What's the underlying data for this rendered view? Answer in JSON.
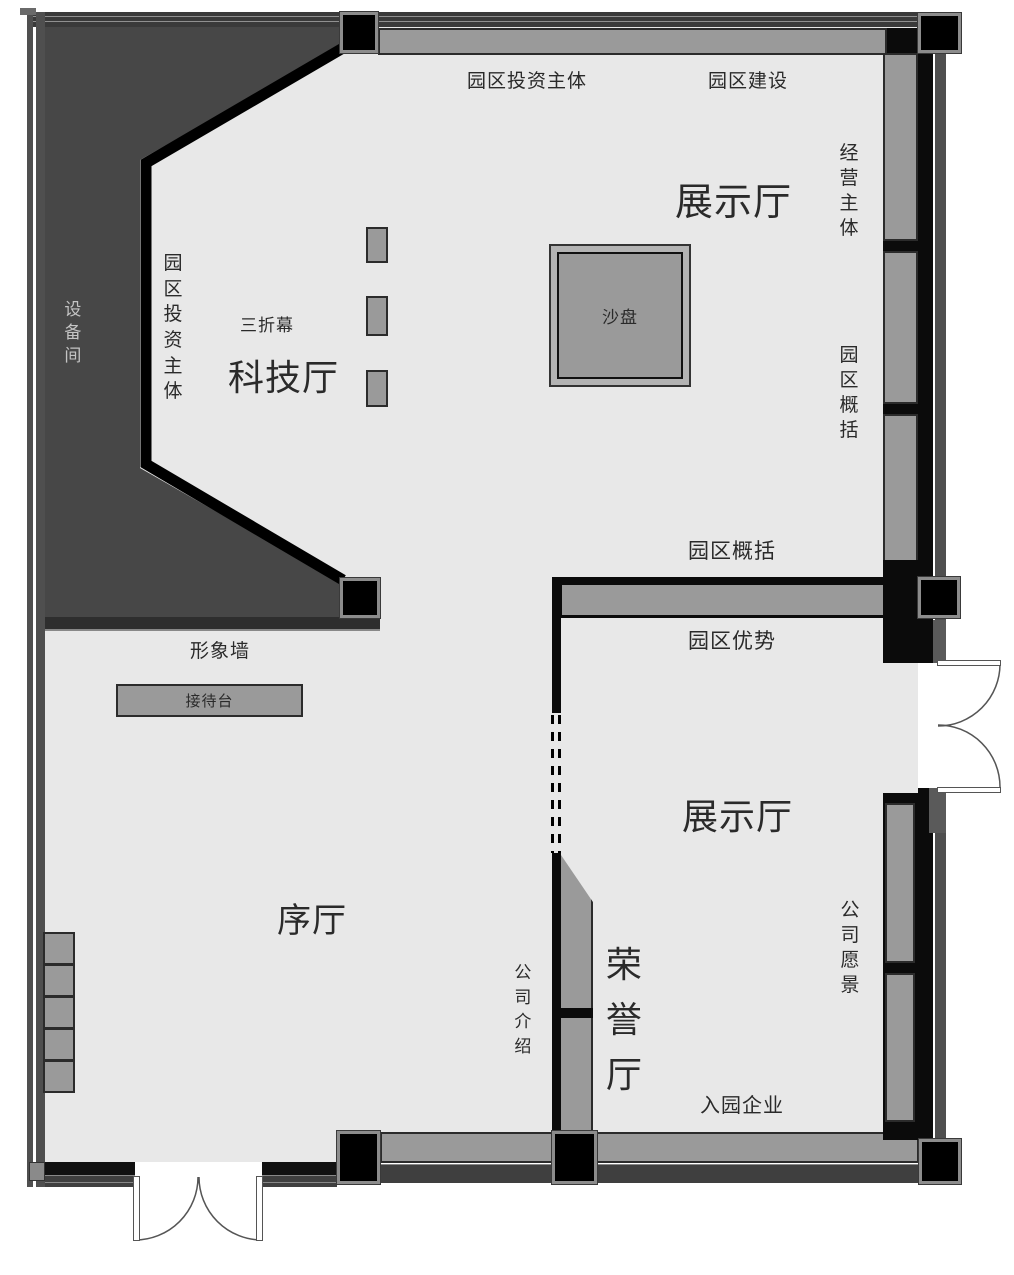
{
  "title": "exhibition-hall-floor-plan",
  "labels": {
    "park_investor_top": "园区投资主体",
    "park_construction": "园区建设",
    "exhibition_hall_upper": "展示厅",
    "operating_entity": "经营主体",
    "equipment_room": "设备间",
    "park_investor_left": "园区投资主体",
    "triple_screen": "三折幕",
    "tech_hall": "科技厅",
    "sand_table": "沙盘",
    "park_overview_right": "园区概括",
    "park_overview_mid": "园区概括",
    "park_advantage": "园区优势",
    "image_wall": "形象墙",
    "reception_desk": "接待台",
    "foyer": "序厅",
    "exhibition_hall_lower": "展示厅",
    "company_vision": "公司愿景",
    "company_intro": "公司介绍",
    "honor_hall": "荣誉厅",
    "enterprises_in_park": "入园企业"
  },
  "colors": {
    "floor": "#e8e8e8",
    "equipment_room_fill": "#474747",
    "wall_black": "#0b0b0b",
    "display_panel_gray": "#9a9a9a",
    "outer_trim_gray": "#4f4f4f",
    "column_border_gray": "#8c8c8c",
    "label_text": "#2a2a2a",
    "equipment_label_text": "#c4c4c4"
  }
}
